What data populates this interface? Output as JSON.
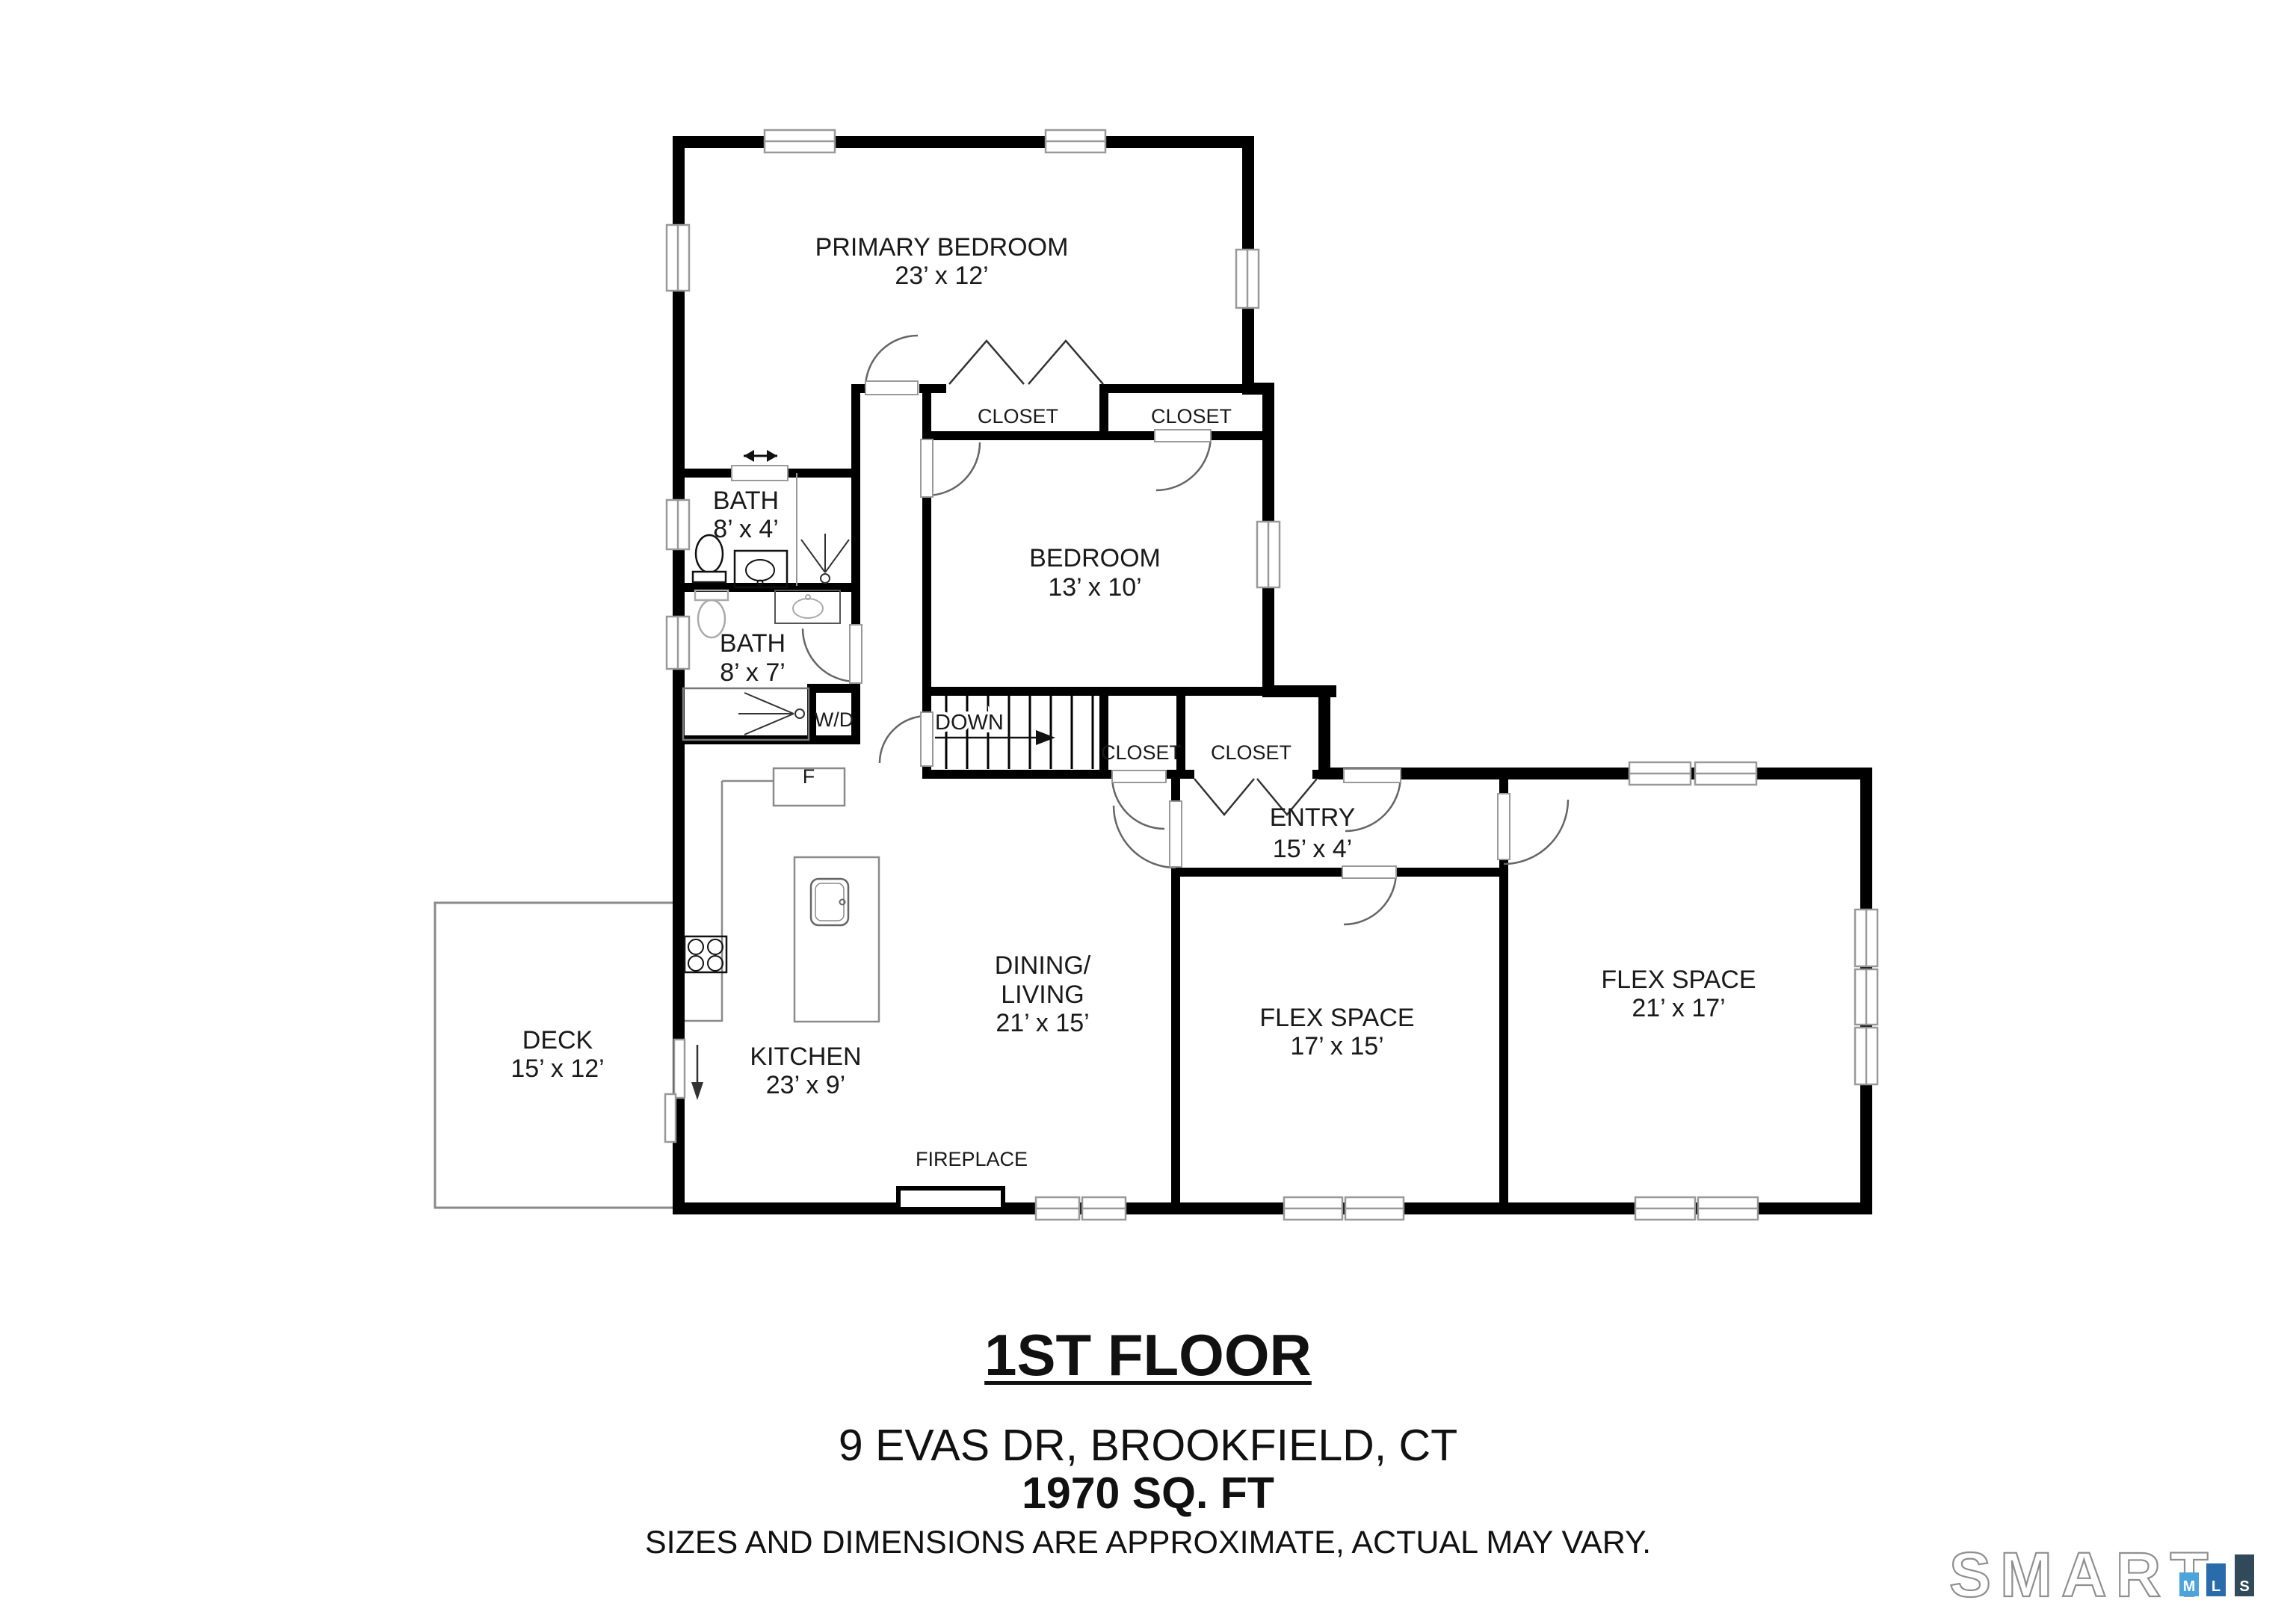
{
  "plan": {
    "rooms": {
      "primary_bedroom": {
        "name": "PRIMARY BEDROOM",
        "dims": "23’ x 12’"
      },
      "bedroom": {
        "name": "BEDROOM",
        "dims": "13’ x 10’"
      },
      "bath_upper": {
        "name": "BATH",
        "dims": "8’ x 4’"
      },
      "bath_lower": {
        "name": "BATH",
        "dims": "8’ x 7’"
      },
      "entry": {
        "name": "ENTRY",
        "dims": "15’ x 4’"
      },
      "dining_living": {
        "name_line1": "DINING/",
        "name_line2": "LIVING",
        "dims": "21’ x 15’"
      },
      "kitchen": {
        "name": "KITCHEN",
        "dims": "23’ x 9’"
      },
      "flex_space_1": {
        "name": "FLEX SPACE",
        "dims": "17’ x 15’"
      },
      "flex_space_2": {
        "name": "FLEX SPACE",
        "dims": "21’ x 17’"
      },
      "deck": {
        "name": "DECK",
        "dims": "15’ x 12’"
      }
    },
    "features": {
      "closet_1": "CLOSET",
      "closet_2": "CLOSET",
      "closet_3": "CLOSET",
      "closet_4": "CLOSET",
      "stairs": "DOWN",
      "washer_dryer": "W/D",
      "refrigerator": "F",
      "fireplace": "FIREPLACE"
    },
    "footer": {
      "floor_title": "1ST FLOOR",
      "address": "9 EVAS DR, BROOKFIELD, CT",
      "area": "1970 SQ. FT",
      "disclaimer": "SIZES AND DIMENSIONS ARE APPROXIMATE, ACTUAL MAY VARY."
    }
  },
  "logo": {
    "brand": "SMART",
    "bars": [
      {
        "letter": "M",
        "color": "#4da4dd"
      },
      {
        "letter": "L",
        "color": "#2a6cab"
      },
      {
        "letter": "S",
        "color": "#304a59"
      }
    ]
  }
}
